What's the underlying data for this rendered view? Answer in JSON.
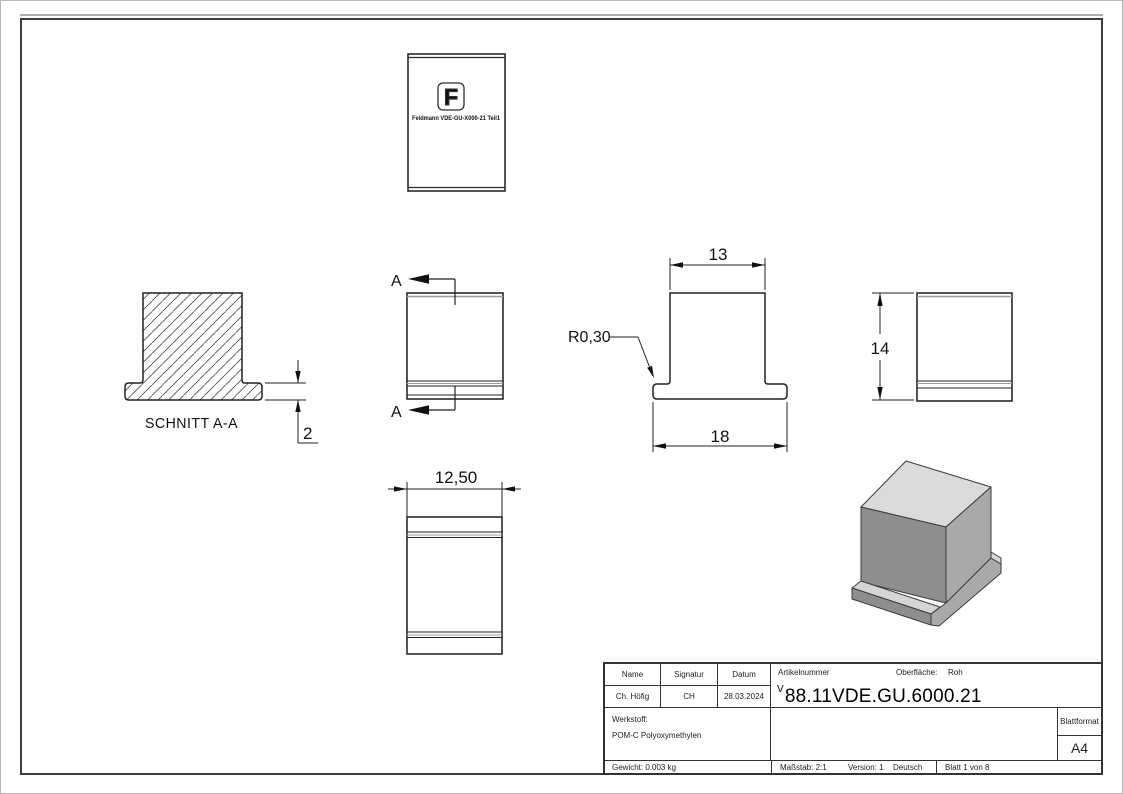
{
  "drawing": {
    "section_label": "SCHNITT A-A",
    "section_marker": "A",
    "logo_letter": "F",
    "logo_text": "Feldmann VDE-GU-X000-21 Teil1",
    "dimensions": {
      "top_width": "13",
      "base_width": "18",
      "fillet_radius": "R0,30",
      "height": "14",
      "depth": "12,50",
      "flange_thickness": "2"
    }
  },
  "title_block": {
    "name_label": "Name",
    "signatur_label": "Signatur",
    "datum_label": "Datum",
    "name_value": "Ch. Höfig",
    "signatur_value": "CH",
    "datum_value": "28.03.2024",
    "artikelnummer_label": "Artikelnummer",
    "oberflaeche_label": "Oberfläche:",
    "oberflaeche_value": "Roh",
    "artikelnummer_prefix": "V",
    "artikelnummer_value": "88.11VDE.GU.6000.21",
    "werkstoff_label": "Werkstoff:",
    "werkstoff_value": "POM-C Polyoxymethylen",
    "blattformat_label": "Blattformat",
    "blattformat_value": "A4",
    "gewicht": "Gewicht: 0.003 kg",
    "massstab": "Maßstab: 2:1",
    "version": "Version: 1",
    "sprache": "Deutsch",
    "blatt": "Blatt 1 von 8"
  },
  "colors": {
    "edge": "#2a2a2a",
    "tangent": "#9a9a9a",
    "iso_top": "#dbdbdb",
    "iso_front": "#8e8e8e",
    "iso_right": "#a9a9a9"
  }
}
